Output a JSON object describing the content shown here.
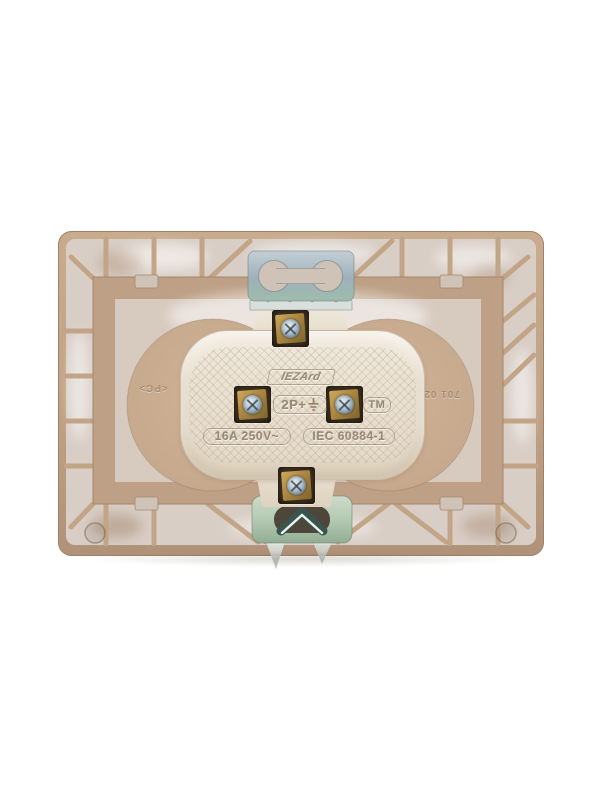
{
  "page": {
    "background_color": "#ffffff"
  },
  "product": {
    "description": "Rear view of a beige LEZARD electrical wall socket showing mounting brackets, ceramic core and screw terminals",
    "markings": {
      "brand": "lEZArd",
      "poles": "2P+",
      "earth_symbol_name": "earth-ground-icon",
      "trademark": "TM",
      "rating": "16A 250V~",
      "standard": "IEC 60884-1",
      "material": "<PC>",
      "mold_code": "701 0203"
    },
    "colors": {
      "plate_tan": "#c2a487",
      "panel_light": "#d9cec6",
      "inner_frame": "#bda085",
      "mechanism_circle": "#c9ac90",
      "ceramic_cream": "#eae1d2",
      "brass_terminal": "#ab8742",
      "screw_steel": "#b9c6d0",
      "bracket_steel_blue": "#a7bcc4",
      "bracket_pale_green": "#b6ccb4",
      "chevron_spring": "#3a554e"
    }
  }
}
